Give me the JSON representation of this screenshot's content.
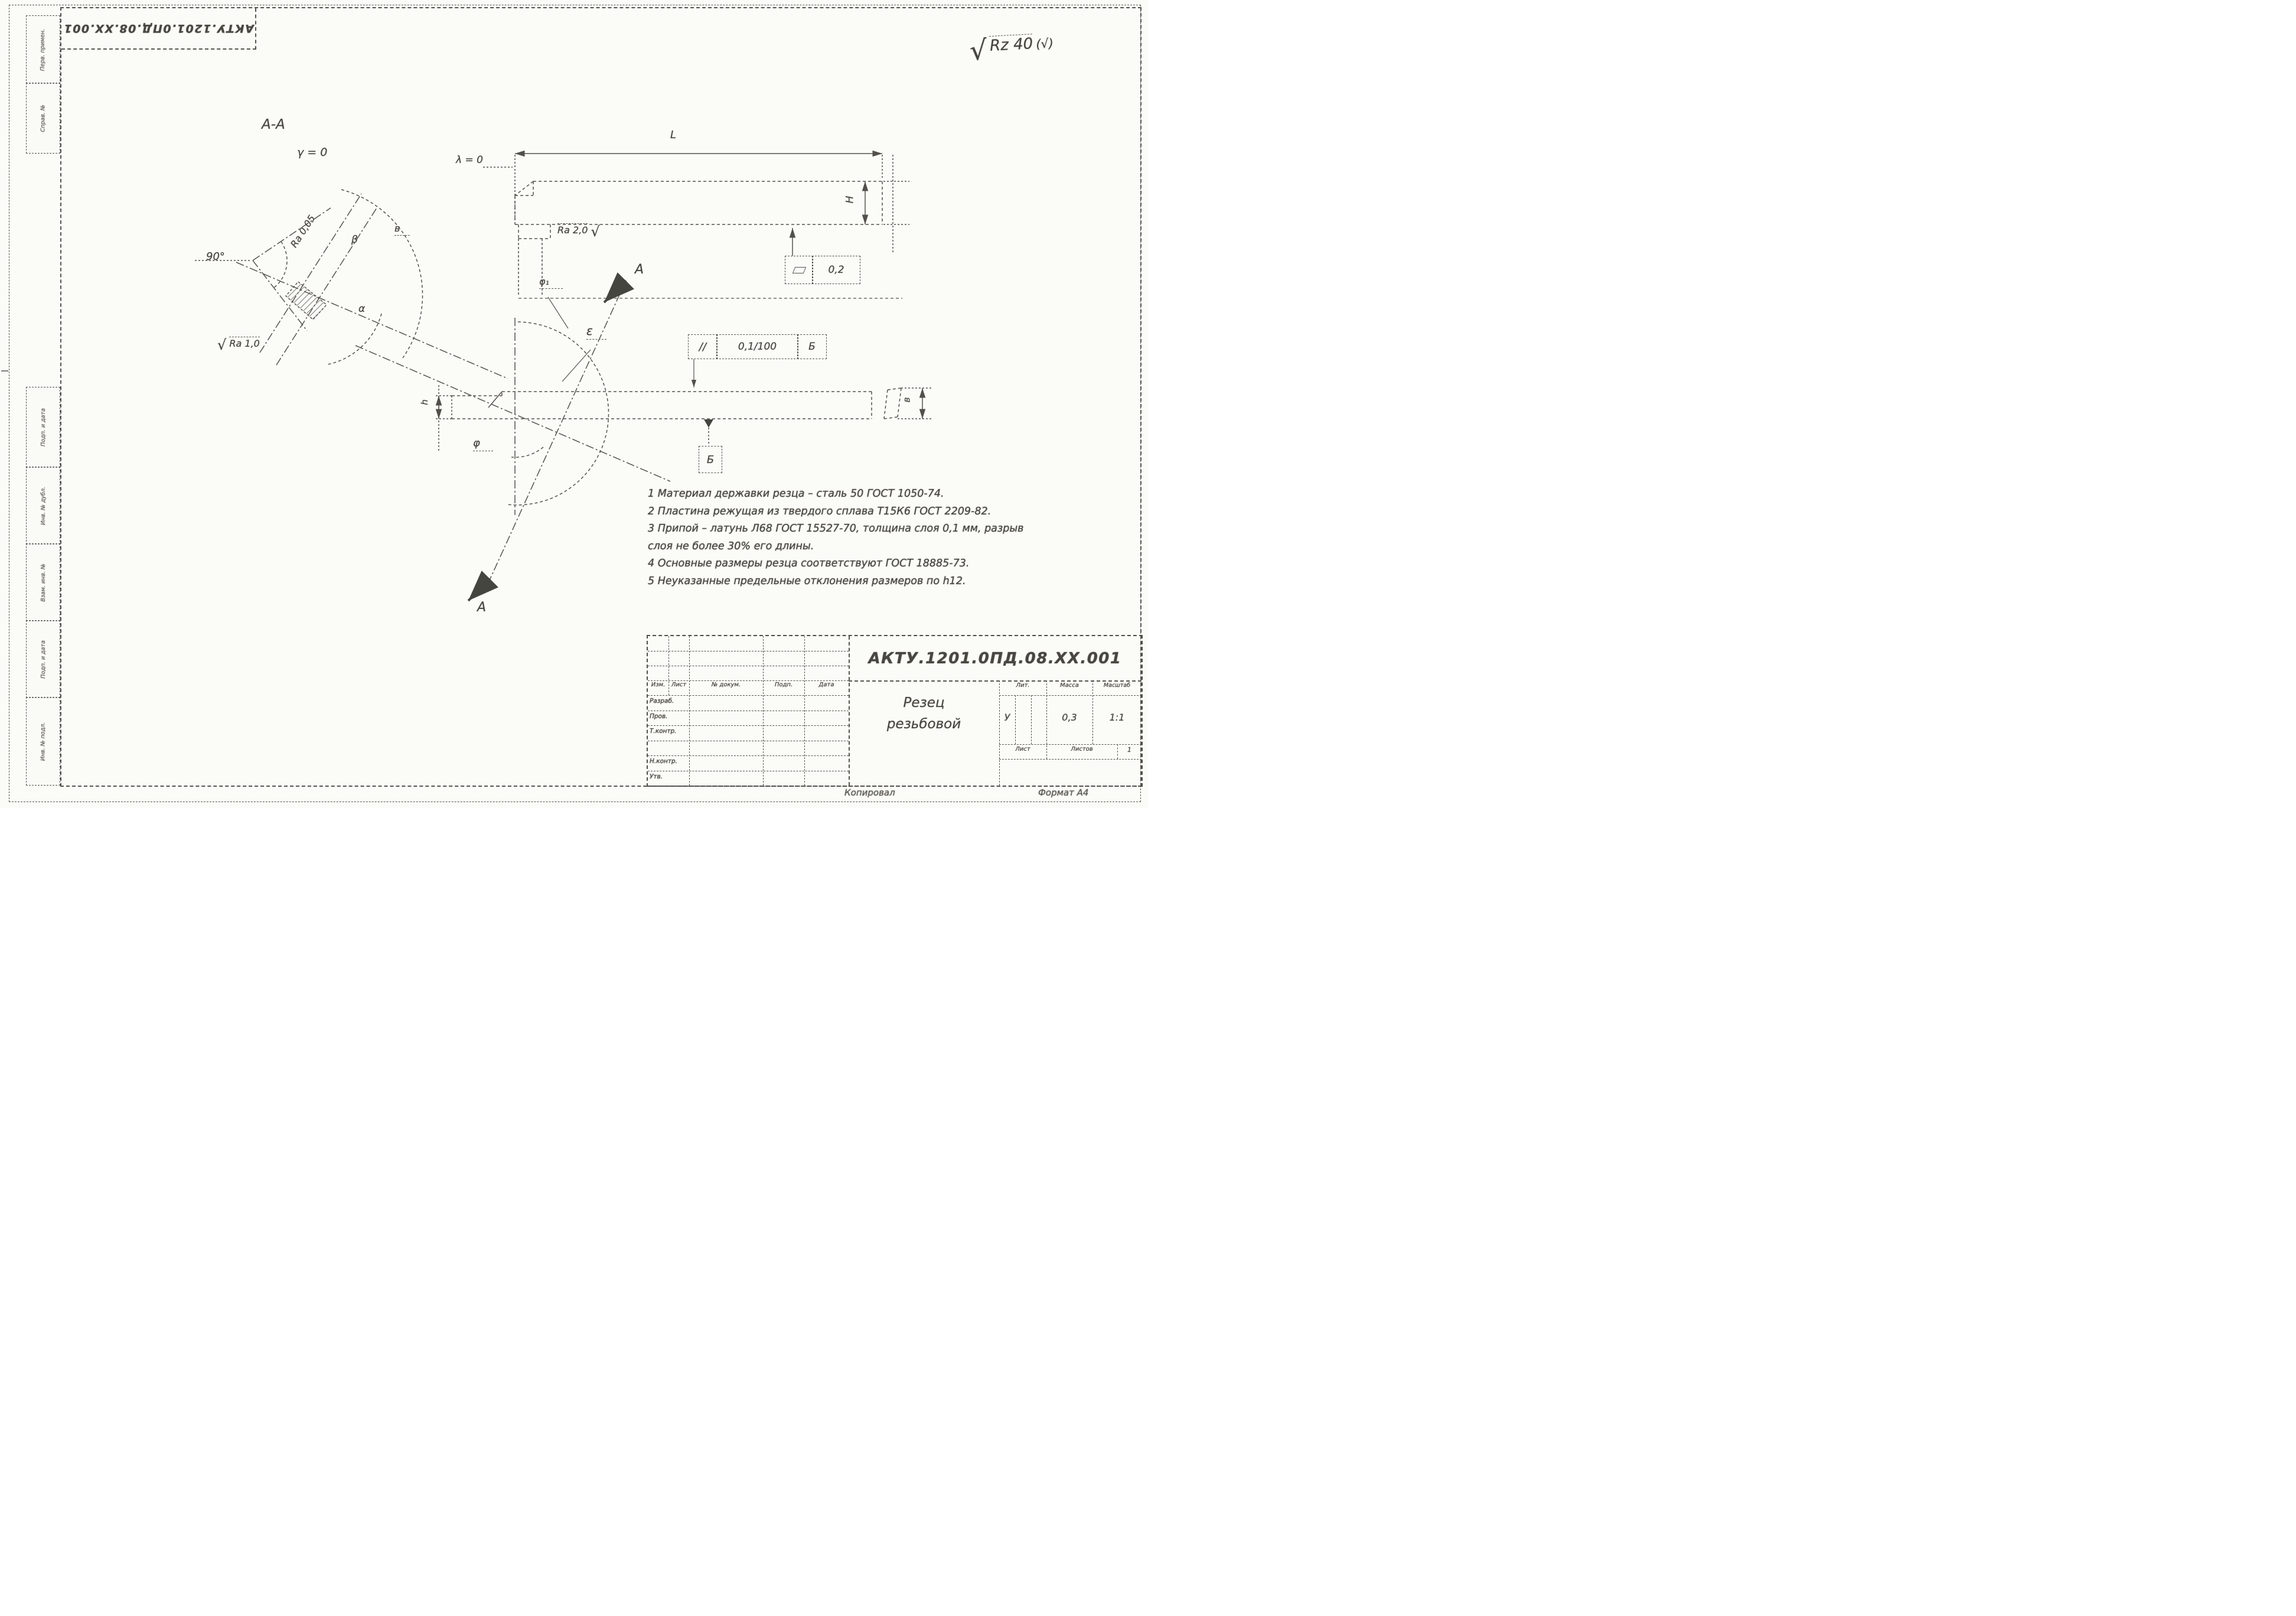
{
  "stamp": {
    "doc_number": "АКТУ.1201.0ПД.08.ХХ.001"
  },
  "roughness": {
    "general_radical": "√",
    "general_value": "Rz 40",
    "general_suffix": "(√)",
    "face_value": "Ra 0,05",
    "flank_radical": "√",
    "flank_value": "Ra 1,0",
    "shank_value": "Ra 2,0",
    "shank_radical": "√"
  },
  "section_aa": {
    "title": "А-А",
    "gamma": "γ = 0",
    "angle_90": "90°",
    "beta": "β",
    "alpha": "α",
    "v": "в"
  },
  "side_view": {
    "lambda": "λ = 0",
    "dim_length": "L",
    "dim_height": "H",
    "flatness_value": "0,2"
  },
  "main_view": {
    "epsilon": "ε",
    "phi1": "φ₁",
    "phi": "φ",
    "dim_h": "h",
    "dim_b": "в",
    "section_label_top": "А",
    "section_label_bottom": "А",
    "parallelism_symbol": "∕∕",
    "parallelism_value": "0,1/100",
    "parallelism_datum": "Б",
    "datum_flag": "Б"
  },
  "notes": {
    "lines": [
      "1  Материал державки резца – сталь 50 ГОСТ 1050-74.",
      "2  Пластина режущая из твердого сплава Т15К6 ГОСТ 2209-82.",
      "3  Припой – латунь Л68 ГОСТ 15527-70, толщина слоя 0,1 мм, разрыв",
      "слоя не более 30% его длины.",
      "4  Основные размеры резца соответствуют ГОСТ 18885-73.",
      "5  Неуказанные предельные отклонения размеров по h12."
    ]
  },
  "title_block": {
    "doc_number": "АКТУ.1201.0ПД.08.ХХ.001",
    "name_line1": "Резец",
    "name_line2": "резьбовой",
    "col_izm": "Изм.",
    "col_list": "Лист",
    "col_doc": "№ докум.",
    "col_podp": "Подп.",
    "col_data": "Дата",
    "row_razrab": "Разраб.",
    "row_prov": "Пров.",
    "row_tkontr": "Т.контр.",
    "row_nkontr": "Н.контр.",
    "row_utv": "Утв.",
    "lit_header": "Лит.",
    "mass_header": "Масса",
    "scale_header": "Масштаб",
    "lit_value": "У",
    "mass_value": "0,3",
    "scale_value": "1:1",
    "sheet_label": "Лист",
    "sheets_label": "Листов",
    "sheets_value": "1"
  },
  "footer": {
    "copied": "Копировал",
    "format": "Формат А4"
  },
  "margin_column": {
    "top": [
      "Перв. примен.",
      "Справ. №"
    ],
    "bottom": [
      "Подп. и дата",
      "Инв. № дубл.",
      "Взам. инв. №",
      "Подп. и дата",
      "Инв. № подл."
    ]
  }
}
